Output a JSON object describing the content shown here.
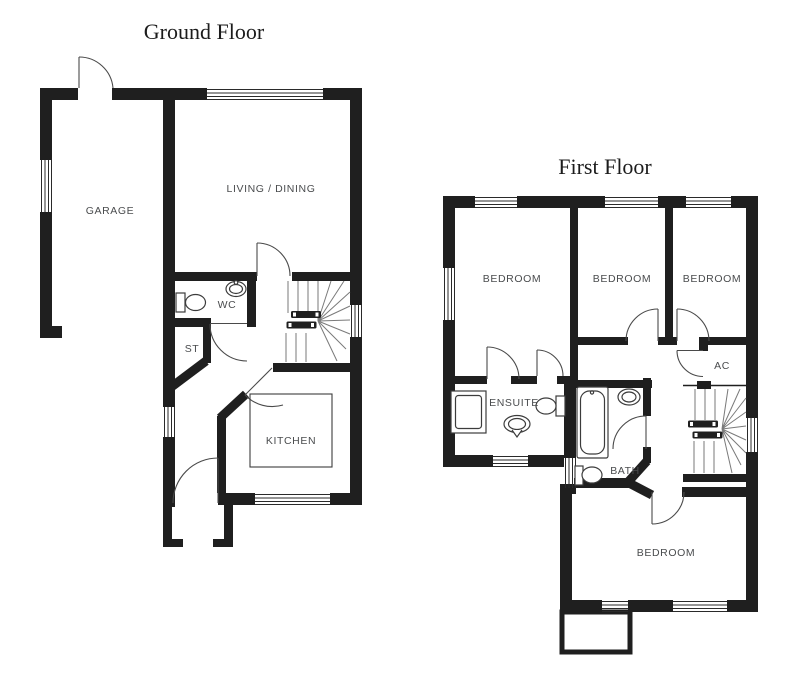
{
  "ground_floor": {
    "title": "Ground Floor",
    "rooms": {
      "garage": "GARAGE",
      "living_dining": "LIVING / DINING",
      "wc": "WC",
      "st": "ST",
      "kitchen": "KITCHEN"
    }
  },
  "first_floor": {
    "title": "First Floor",
    "rooms": {
      "bedroom1": "BEDROOM",
      "bedroom2": "BEDROOM",
      "bedroom3": "BEDROOM",
      "ac": "AC",
      "ensuite": "ENSUITE",
      "bath": "BATH",
      "bedroom4": "BEDROOM"
    }
  },
  "colors": {
    "wall": "#1f1f1f",
    "line": "#4a4a4a",
    "stair": "#7a7a7a",
    "fixture": "#3c3c3c",
    "label": "#4a4c4e",
    "title": "#1c1c1c",
    "background": "#ffffff"
  }
}
